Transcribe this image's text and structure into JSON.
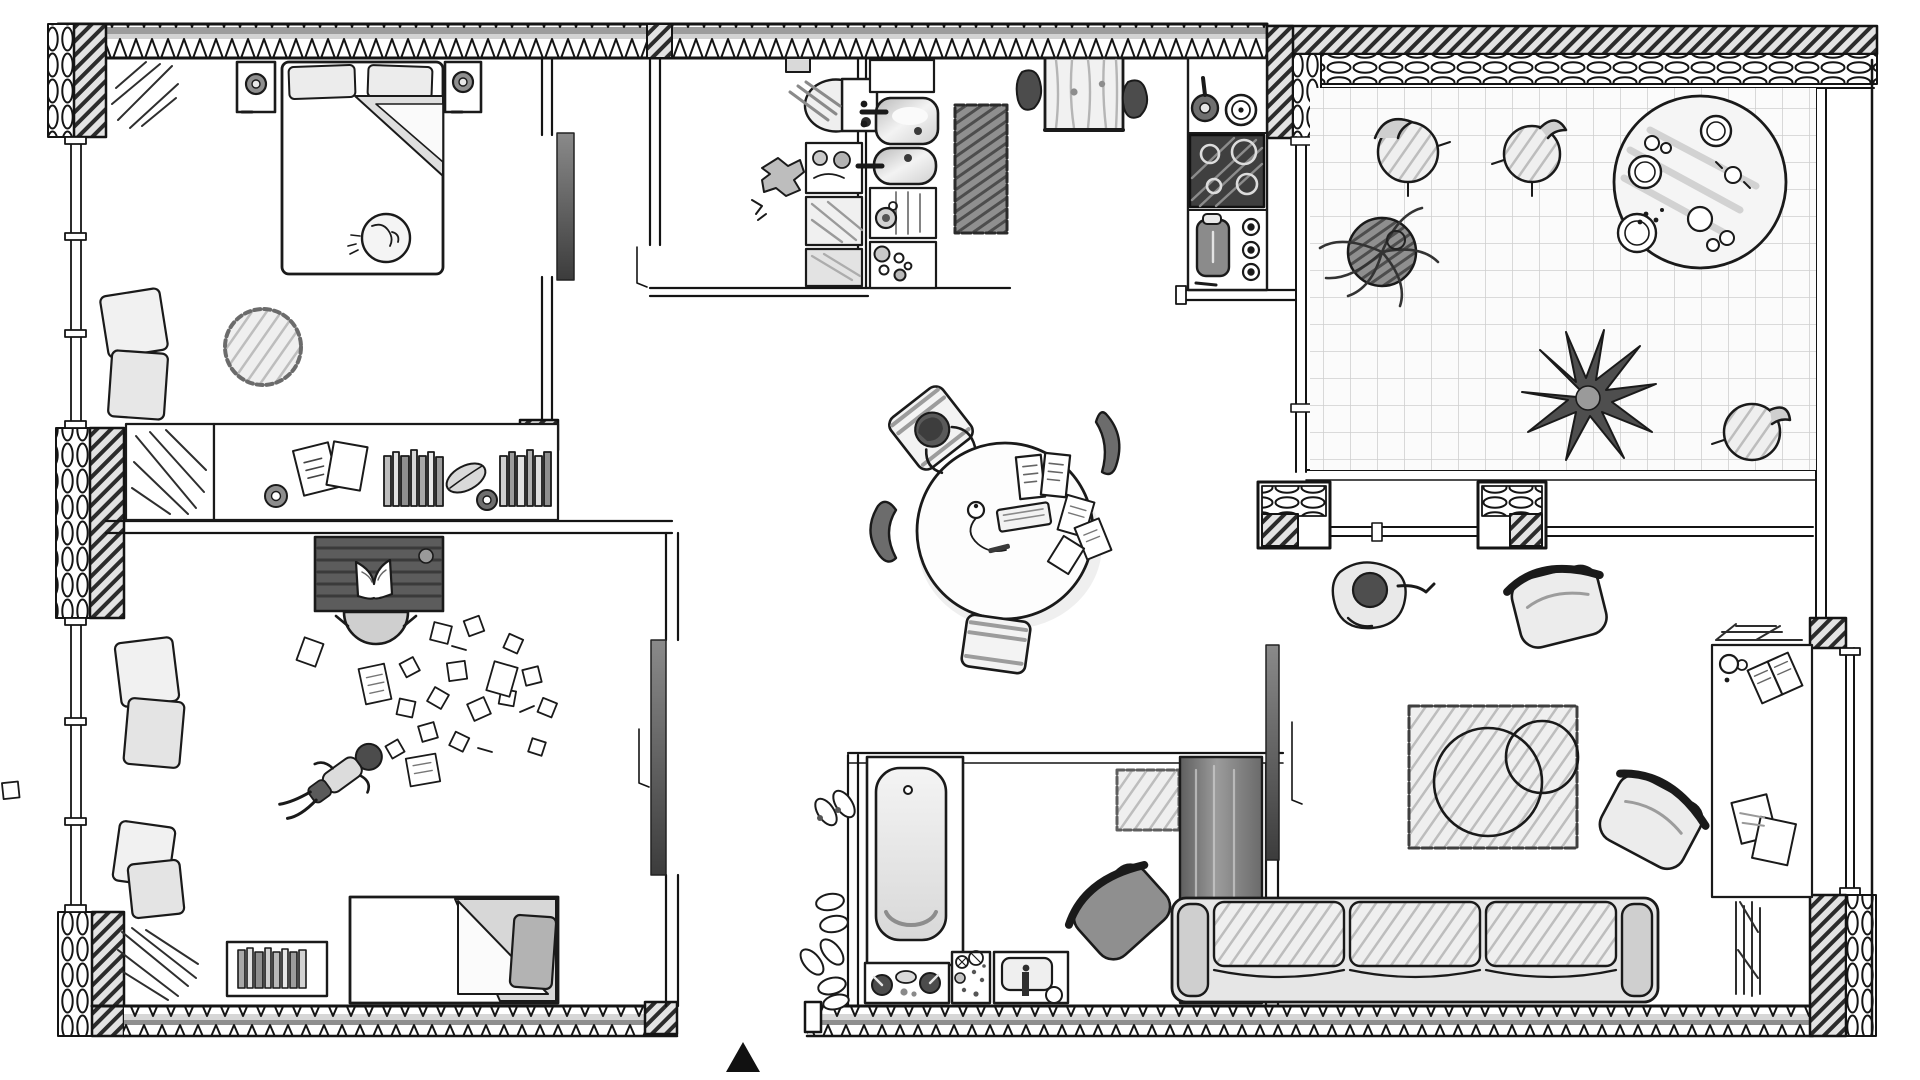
{
  "meta": {
    "title": "Hand-drawn apartment floor plan, top view, black-and-white pencil sketch",
    "style": "monochrome architectural sketch with insulated exterior walls (zig-zag and loop hatching), diagonal-hatched masonry piers, tiled patio",
    "entrance_marker": "solid black triangle below the bottom-center entrance opening"
  },
  "colors": {
    "ink": "#1a1a1a",
    "paper": "#ffffff",
    "wall_gray": "#9c9c9c",
    "light_gray": "#d9d9d9",
    "dark_fill": "#4a4a4a"
  },
  "floor_plan": {
    "rooms": [
      {
        "name": "Main bedroom (top-left)",
        "items": [
          "double bed with two pillows and folded duvet",
          "sleeping cat on bed",
          "left nightstand with lamp",
          "right nightstand with lamp",
          "round shaggy rug",
          "two floor cushions by window",
          "wardrobe with hanging clothes",
          "long shelf with papers, two tape rolls, two rows of books and a leaf"
        ]
      },
      {
        "name": "WC and laundry (top-middle)",
        "items": [
          "toilet with cistern",
          "wall vent",
          "pile of clothes on floor",
          "tap / hose box",
          "laundry hamper",
          "storage box"
        ]
      },
      {
        "name": "Kitchen (top-middle-right)",
        "items": [
          "upper cabinet",
          "double sink with taps",
          "worktop with drain",
          "jar cluster",
          "dark runner rug",
          "small wooden table",
          "two black stools",
          "frying pan",
          "pot",
          "four-burner hob",
          "kettle",
          "three control knobs",
          "spoon"
        ]
      },
      {
        "name": "Patio terrace (top-right)",
        "items": [
          "tiled floor",
          "three round garden chairs",
          "large round table with plates and snacks",
          "potted trailing plant",
          "agave plant"
        ]
      },
      {
        "name": "Dining / study (center)",
        "items": [
          "round table",
          "open book",
          "keyboard",
          "mouse with cable",
          "loose papers",
          "pen",
          "striped chair top-left",
          "striped chair bottom",
          "black curved chair left",
          "black curved chair right"
        ]
      },
      {
        "name": "Office bedroom (bottom-left)",
        "items": [
          "dark wooden desk with open notebook",
          "desk chair",
          "single bed with folded blanket and grey pillow",
          "floor book rack",
          "four floor cushions by window",
          "scattered note papers",
          "radiator scribble"
        ]
      },
      {
        "name": "Bathroom (bottom-middle)",
        "items": [
          "bathtub in alcove",
          "vanity with two taps",
          "toiletries tray",
          "washbasin with tall tap",
          "bath mat",
          "tall shower cabinet"
        ]
      },
      {
        "name": "Living room (bottom-right)",
        "items": [
          "three-seat sofa",
          "two light armchairs",
          "one dark armchair",
          "rug with two overlapping circles",
          "window-side desk with cup, open book and papers",
          "two radiator scribbles"
        ]
      },
      {
        "name": "Entrance hall (bottom-center)",
        "items": [
          "four pairs of slippers",
          "entrance opening with black triangle marker"
        ]
      }
    ],
    "people": [
      {
        "where": "dining table",
        "pose": "sitting on striped chair working at the table"
      },
      {
        "where": "office floor",
        "pose": "lying diagonally among scattered papers"
      },
      {
        "where": "living room floor",
        "pose": "sitting below the window wall with one arm raised"
      }
    ],
    "architecture": {
      "exterior_walls": "top and bottom walls with triangle zig-zag insulation, patio walls with diagonal hatch and loop insulation",
      "piers": "diagonal-hatched masonry blocks at corners and junctions",
      "windows": [
        "two window bands on the left wall",
        "glazing between kitchen and patio",
        "clerestory band between patio and living room",
        "right glass facade"
      ],
      "doors": [
        "main bedroom door with open leaf",
        "WC door swing mark",
        "office door with open leaf",
        "living room door with open leaf"
      ],
      "entrance": "bottom-center opening with black triangle marker"
    }
  }
}
